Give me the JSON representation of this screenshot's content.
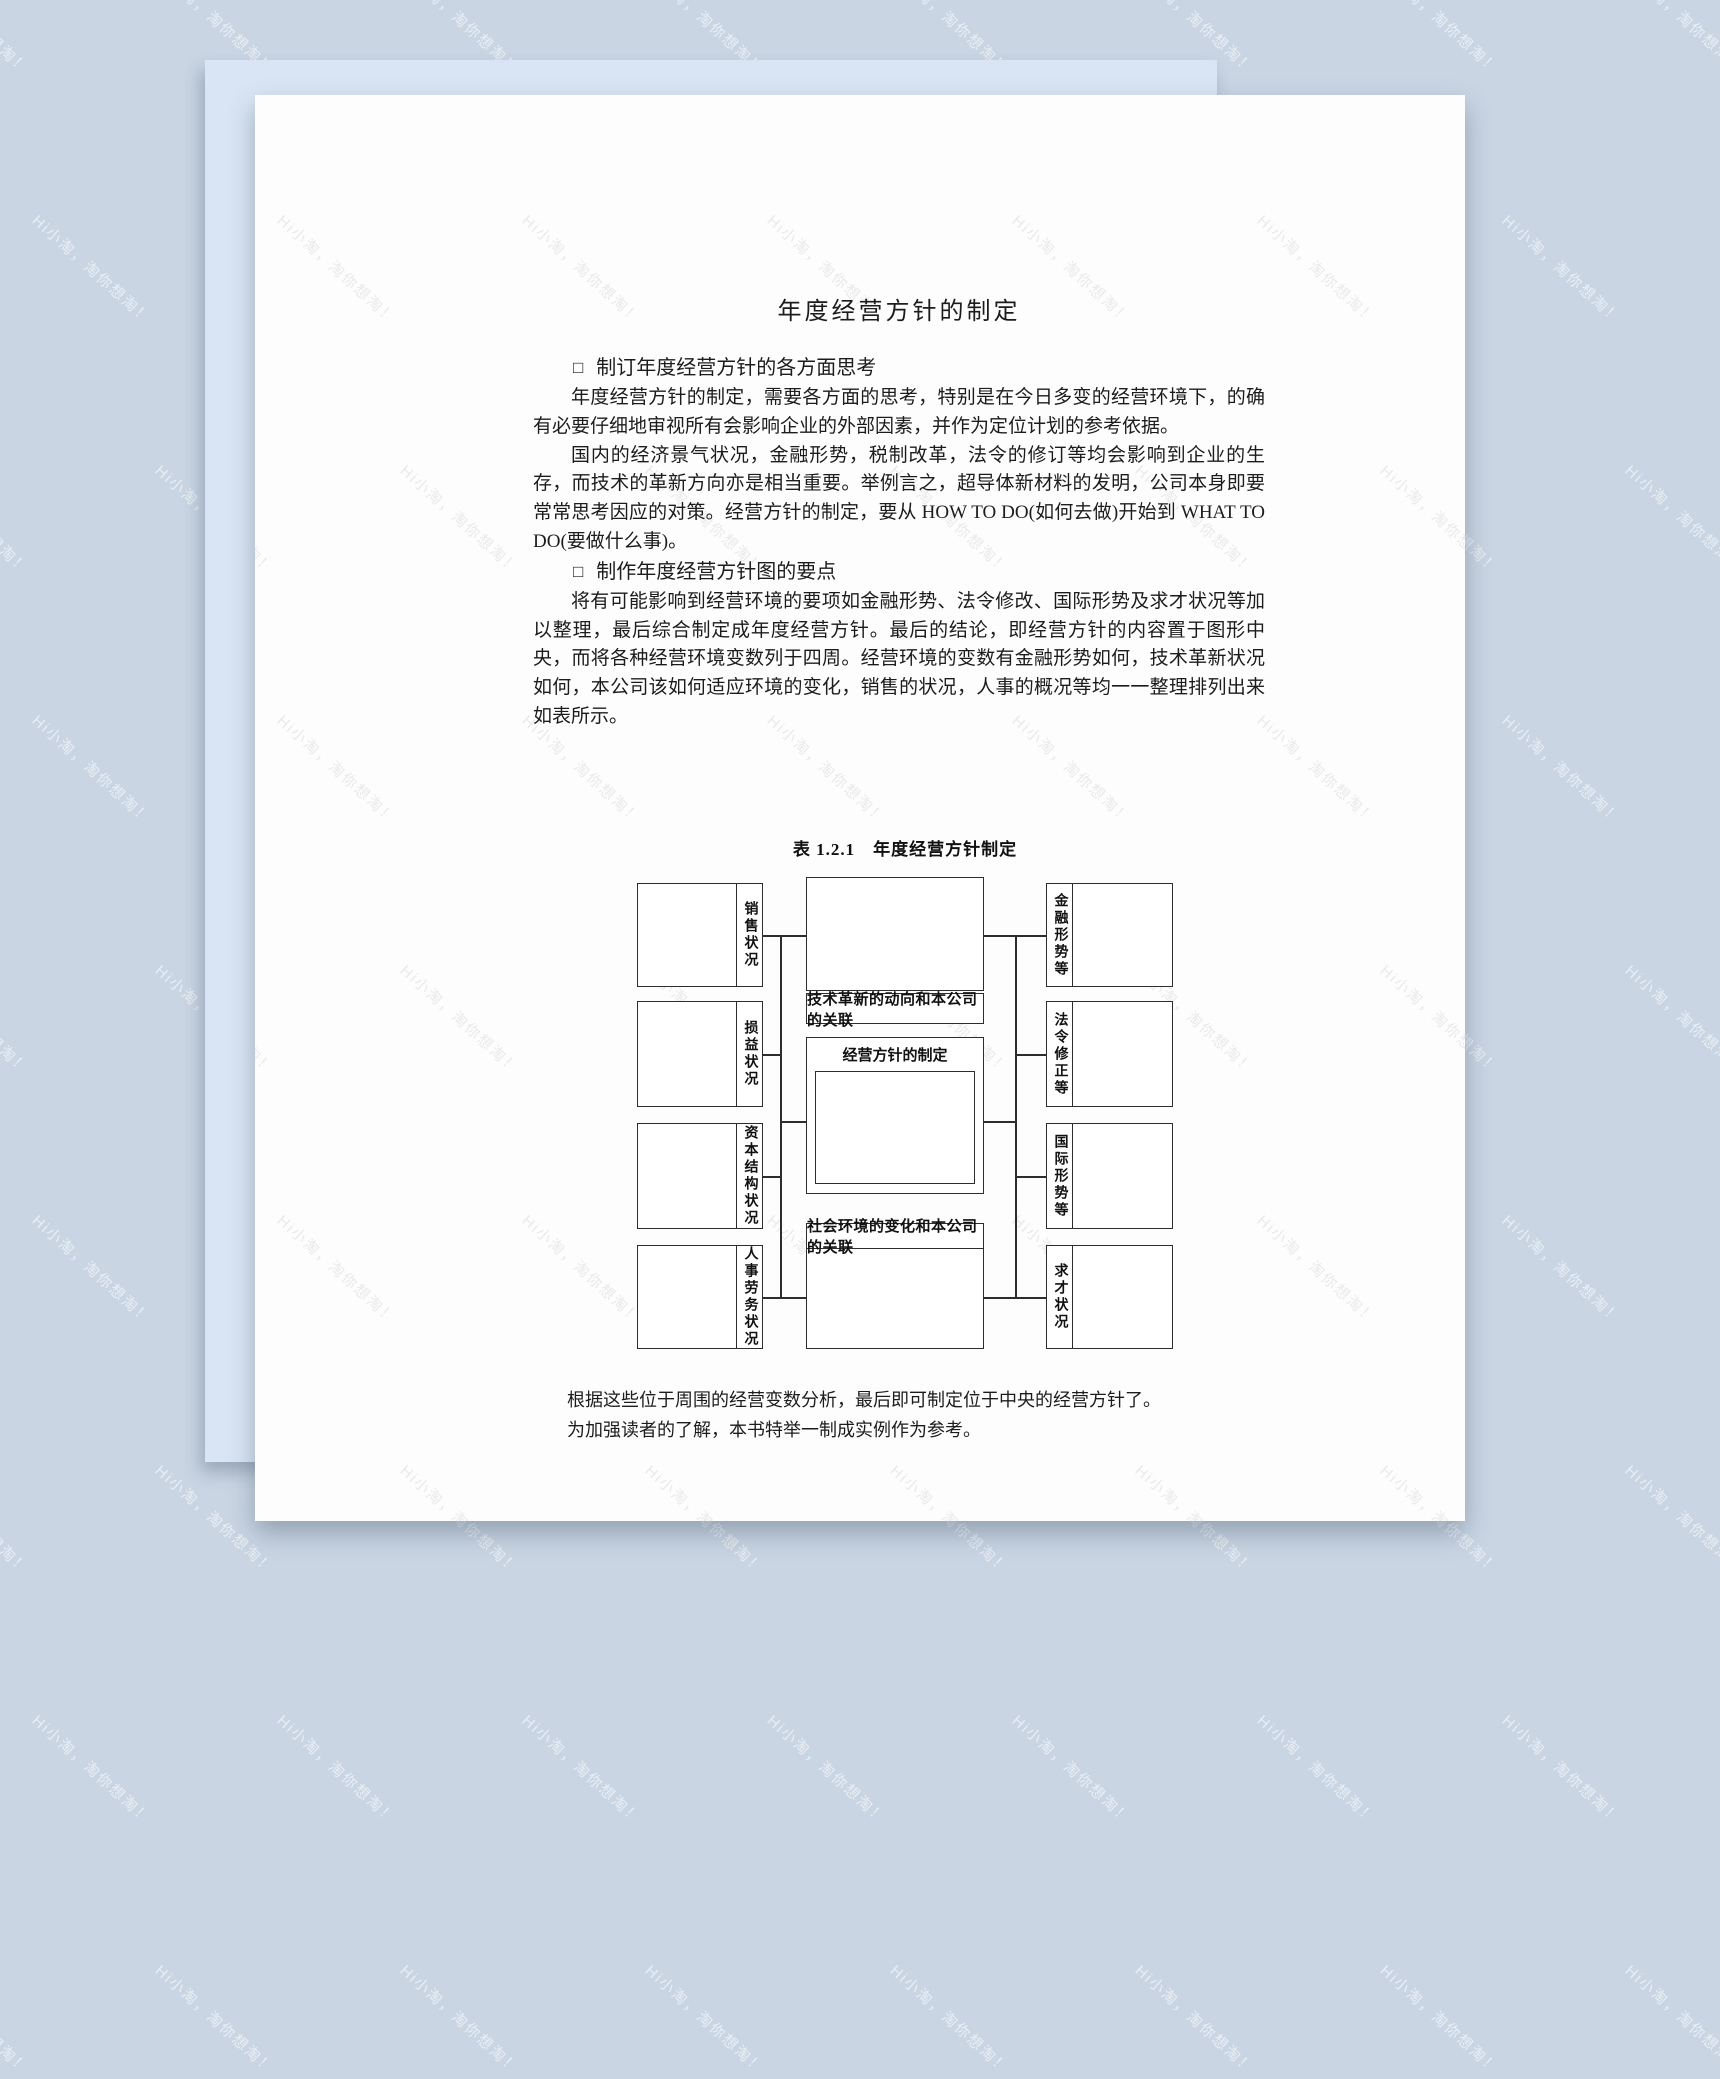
{
  "colors": {
    "background": "#c9d5e3",
    "back-sheet": "#d9e5f4",
    "page": "#fdfdfd"
  },
  "watermark": {
    "text": "Hi小淘，淘你想淘！"
  },
  "doc": {
    "title": "年度经营方针的制定",
    "sections": [
      {
        "bullet": "□",
        "heading": "制订年度经营方针的各方面思考",
        "paragraphs": [
          "年度经营方针的制定，需要各方面的思考，特别是在今日多变的经营环境下，的确有必要仔细地审视所有会影响企业的外部因素，并作为定位计划的参考依据。",
          "国内的经济景气状况，金融形势，税制改革，法令的修订等均会影响到企业的生存，而技术的革新方向亦是相当重要。举例言之，超导体新材料的发明，公司本身即要常常思考因应的对策。经营方针的制定，要从 HOW TO DO(如何去做)开始到 WHAT TO DO(要做什么事)。"
        ]
      },
      {
        "bullet": "□",
        "heading": "制作年度经营方针图的要点",
        "paragraphs": [
          "将有可能影响到经营环境的要项如金融形势、法令修改、国际形势及求才状况等加以整理，最后综合制定成年度经营方针。最后的结论，即经营方针的内容置于图形中央，而将各种经营环境变数列于四周。经营环境的变数有金融形势如何，技术革新状况如何，本公司该如何适应环境的变化，销售的状况，人事的概况等均一一整理排列出来如表所示。"
        ]
      }
    ]
  },
  "figure": {
    "caption": "表 1.2.1　年度经营方针制定",
    "left_boxes": [
      "销售状况",
      "损益状况",
      "资本结构状况",
      "人事劳务状况"
    ],
    "right_boxes": [
      "金融形势等",
      "法令修正等",
      "国际形势等",
      "求才状况"
    ],
    "center": {
      "top_strip": "技术革新的动向和本公司的关联",
      "middle_title": "经营方针的制定",
      "bottom_strip": "社会环境的变化和本公司的关联"
    }
  },
  "closing": [
    "根据这些位于周围的经营变数分析，最后即可制定位于中央的经营方针了。",
    "为加强读者的了解，本书特举一制成实例作为参考。"
  ]
}
